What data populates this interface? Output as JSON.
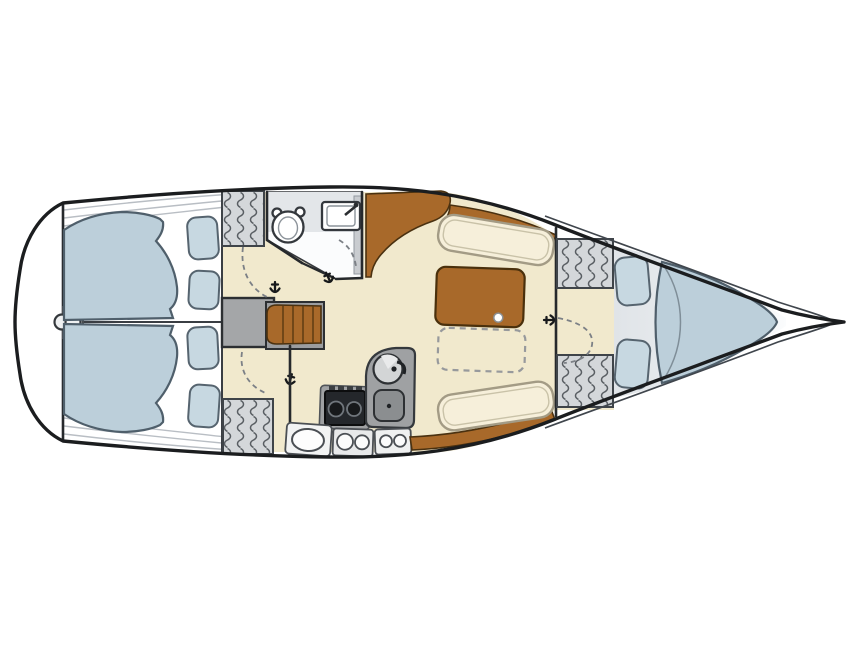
{
  "canvas": {
    "width": 860,
    "height": 645,
    "background": "#ffffff"
  },
  "diagram": {
    "type": "sailboat-interior-floor-plan",
    "view": "overhead-deck-plan",
    "orientation": {
      "bow": "right",
      "stern": "left"
    }
  },
  "colors": {
    "hull_outline": "#1b1d1f",
    "deck_line": "#b9bec4",
    "floor": "#f1e9cd",
    "head_floor": "#fbfcfd",
    "counter": "#e3e6e9",
    "mattress": "#bccfda",
    "pillow": "#c7d8e1",
    "settee": "#f6efda",
    "settee_edge": "#a39b85",
    "wood": "#a8692a",
    "gray": "#9fa1a3",
    "landing_gray": "#a4a6a8",
    "stove": "#24272b",
    "locker_fill": "#d4d7da",
    "coil": "#595e63",
    "bow_shadow": "#e0e4e8",
    "white_fixture": "#ffffff"
  },
  "sections": {
    "stern": {
      "features": [
        "transom",
        "rudder-post-fitting",
        "centerline-partition"
      ],
      "berths": [
        "port-aft-double-berth",
        "starboard-aft-double-berth"
      ],
      "pillows": 4,
      "hanging_lockers": 2
    },
    "head": {
      "fixtures": [
        "marine-toilet",
        "washbasin-with-faucet",
        "counter",
        "storage-shelf"
      ],
      "door": "swing-door"
    },
    "companionway": {
      "steps": 4,
      "landing": true
    },
    "galley": {
      "fixtures": [
        "two-burner-stove",
        "round-sink-with-faucet",
        "icebox-basin"
      ],
      "burners": 2,
      "storage_hatches": 5
    },
    "salon": {
      "settees": 2,
      "table": {
        "folding_leaf_pin": true,
        "fold_out_extension": "dashed-outline"
      },
      "wood_trim": [
        "sideboard-cabinet",
        "starboard-trim",
        "port-trim"
      ]
    },
    "forward_cabin": {
      "berth": "v-berth",
      "pillows": 2,
      "hanging_lockers": 2,
      "door": "swing-door"
    },
    "bow": {
      "features": [
        "anchor-locker-tip"
      ]
    }
  },
  "doors": [
    {
      "id": "head-door"
    },
    {
      "id": "port-aft-cabin-door"
    },
    {
      "id": "starboard-aft-cabin-door"
    },
    {
      "id": "forward-cabin-door"
    }
  ],
  "symbols": {
    "hanging_locker": "coil-hatch-lines",
    "door_swing": "dashed-arc",
    "door_hinge": "hook-glyph"
  }
}
